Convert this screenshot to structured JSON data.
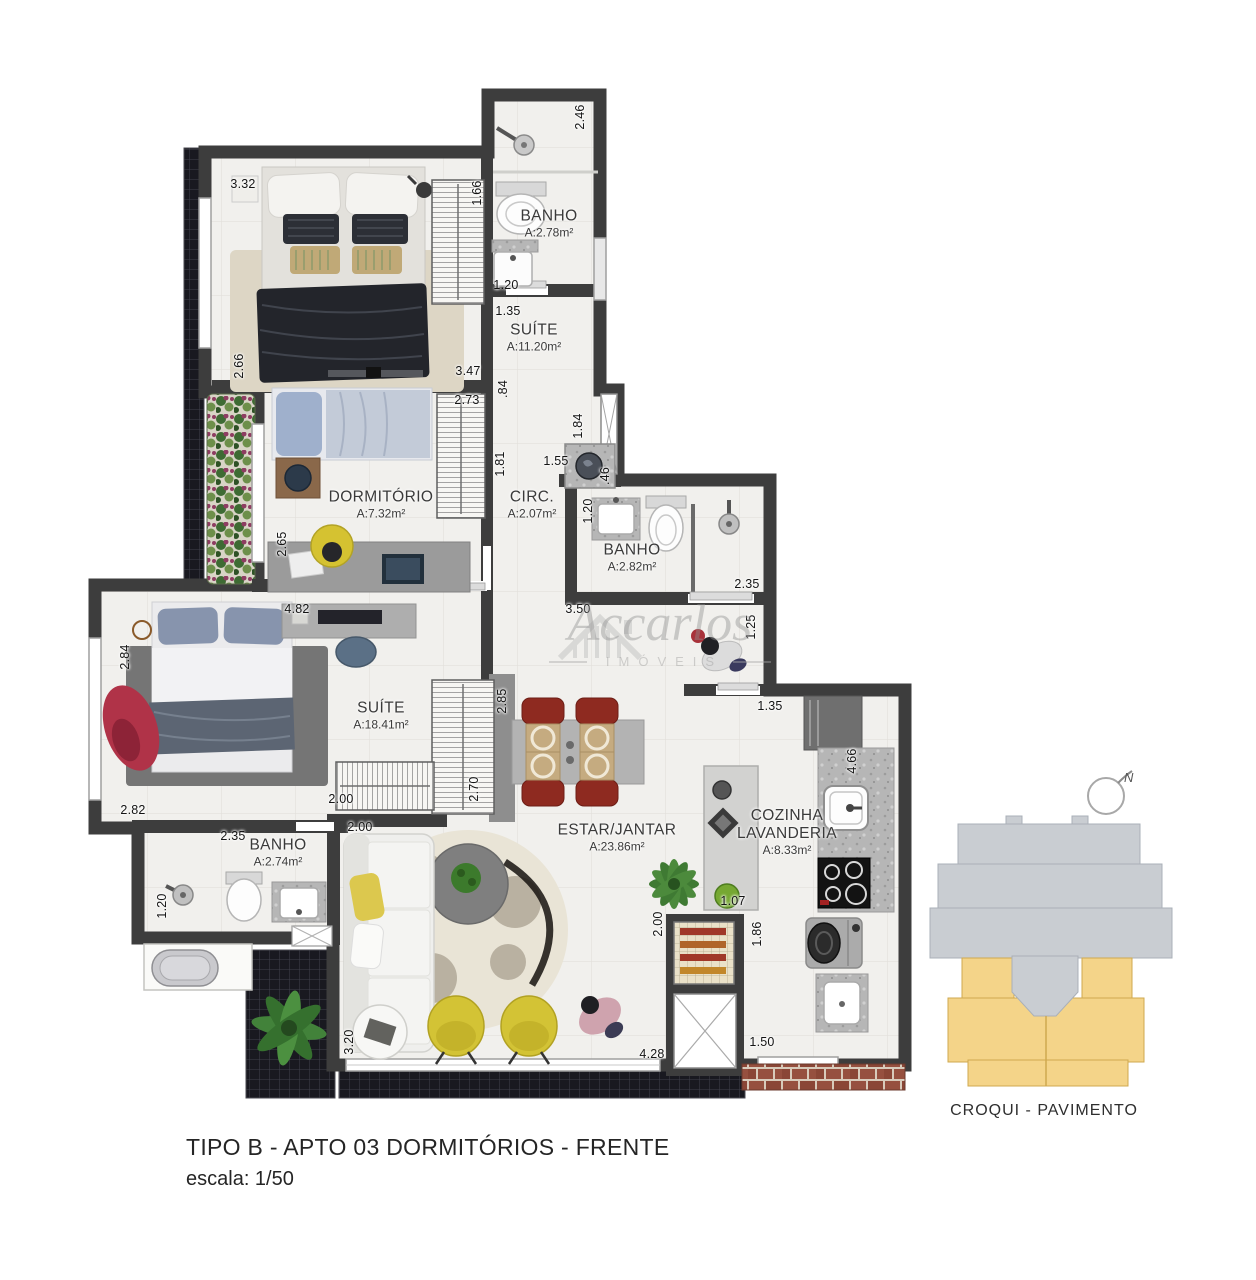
{
  "watermark": {
    "name": "Accarlos",
    "subtitle": "IMÓVEIS"
  },
  "plan": {
    "rooms": [
      {
        "name": "BANHO",
        "area": "A:2.78m²",
        "x": 549,
        "y": 224,
        "wrap": false
      },
      {
        "name": "SUÍTE",
        "area": "A:11.20m²",
        "x": 534,
        "y": 338,
        "wrap": false
      },
      {
        "name": "DORMITÓRIO",
        "area": "A:7.32m²",
        "x": 381,
        "y": 505,
        "wrap": false
      },
      {
        "name": "CIRC.",
        "area": "A:2.07m²",
        "x": 532,
        "y": 505,
        "wrap": false
      },
      {
        "name": "BANHO",
        "area": "A:2.82m²",
        "x": 632,
        "y": 558,
        "wrap": false
      },
      {
        "name": "SUÍTE",
        "area": "A:18.41m²",
        "x": 381,
        "y": 716,
        "wrap": false
      },
      {
        "name": "BANHO",
        "area": "A:2.74m²",
        "x": 278,
        "y": 853,
        "wrap": false
      },
      {
        "name": "ESTAR/JANTAR",
        "area": "A:23.86m²",
        "x": 617,
        "y": 838,
        "wrap": false
      },
      {
        "name": "COZINHA LAVANDERIA",
        "area": "A:8.33m²",
        "x": 787,
        "y": 832,
        "wrap": true
      }
    ],
    "dimensions": [
      {
        "t": "2.46",
        "x": 580,
        "y": 117,
        "o": "v"
      },
      {
        "t": "3.32",
        "x": 243,
        "y": 184,
        "o": "h"
      },
      {
        "t": "1.66",
        "x": 477,
        "y": 193,
        "o": "v"
      },
      {
        "t": "1.20",
        "x": 506,
        "y": 285,
        "o": "h"
      },
      {
        "t": "1.35",
        "x": 508,
        "y": 311,
        "o": "h"
      },
      {
        "t": "2.66",
        "x": 239,
        "y": 366,
        "o": "v"
      },
      {
        "t": "3.47",
        "x": 468,
        "y": 371,
        "o": "h"
      },
      {
        "t": "2.73",
        "x": 467,
        "y": 400,
        "o": "h"
      },
      {
        "t": ".84",
        "x": 503,
        "y": 389,
        "o": "v"
      },
      {
        "t": "1.84",
        "x": 578,
        "y": 426,
        "o": "v"
      },
      {
        "t": "1.81",
        "x": 500,
        "y": 464,
        "o": "v"
      },
      {
        "t": "1.55",
        "x": 556,
        "y": 461,
        "o": "h"
      },
      {
        "t": ".46",
        "x": 605,
        "y": 476,
        "o": "v"
      },
      {
        "t": "1.20",
        "x": 588,
        "y": 511,
        "o": "v"
      },
      {
        "t": "2.65",
        "x": 282,
        "y": 544,
        "o": "v"
      },
      {
        "t": "2.35",
        "x": 747,
        "y": 584,
        "o": "h"
      },
      {
        "t": "3.50",
        "x": 578,
        "y": 609,
        "o": "h"
      },
      {
        "t": "4.82",
        "x": 297,
        "y": 609,
        "o": "h"
      },
      {
        "t": "1.25",
        "x": 751,
        "y": 627,
        "o": "v"
      },
      {
        "t": "2.84",
        "x": 125,
        "y": 657,
        "o": "v"
      },
      {
        "t": "2.85",
        "x": 502,
        "y": 701,
        "o": "v"
      },
      {
        "t": "1.35",
        "x": 770,
        "y": 706,
        "o": "h"
      },
      {
        "t": "4.66",
        "x": 852,
        "y": 761,
        "o": "v"
      },
      {
        "t": "2.70",
        "x": 474,
        "y": 789,
        "o": "v"
      },
      {
        "t": "2.00",
        "x": 341,
        "y": 799,
        "o": "h"
      },
      {
        "t": "2.82",
        "x": 133,
        "y": 810,
        "o": "h"
      },
      {
        "t": "2.00",
        "x": 360,
        "y": 827,
        "o": "h"
      },
      {
        "t": "2.35",
        "x": 233,
        "y": 836,
        "o": "h"
      },
      {
        "t": "1.07",
        "x": 733,
        "y": 901,
        "o": "h"
      },
      {
        "t": "1.20",
        "x": 162,
        "y": 906,
        "o": "v"
      },
      {
        "t": "2.00",
        "x": 658,
        "y": 924,
        "o": "v"
      },
      {
        "t": "1.86",
        "x": 757,
        "y": 934,
        "o": "v"
      },
      {
        "t": "3.20",
        "x": 349,
        "y": 1042,
        "o": "v"
      },
      {
        "t": "1.50",
        "x": 762,
        "y": 1042,
        "o": "h"
      },
      {
        "t": "4.28",
        "x": 652,
        "y": 1054,
        "o": "h"
      }
    ]
  },
  "croqui": {
    "caption": "CROQUI - PAVIMENTO",
    "north": "N",
    "building_color": "#c9cdd2",
    "highlight_color": "#f4d489"
  },
  "footer": {
    "title": "TIPO B - APTO 03  DORMITÓRIOS - FRENTE",
    "scale": "escala: 1/50"
  },
  "colors": {
    "wall": "#3d3d3d",
    "floor": "#f1f0ed",
    "balcony_tile": "#191920",
    "brick": "#96503f",
    "accent_chair": "#8e2a20",
    "accent_yellow": "#d3c335"
  }
}
